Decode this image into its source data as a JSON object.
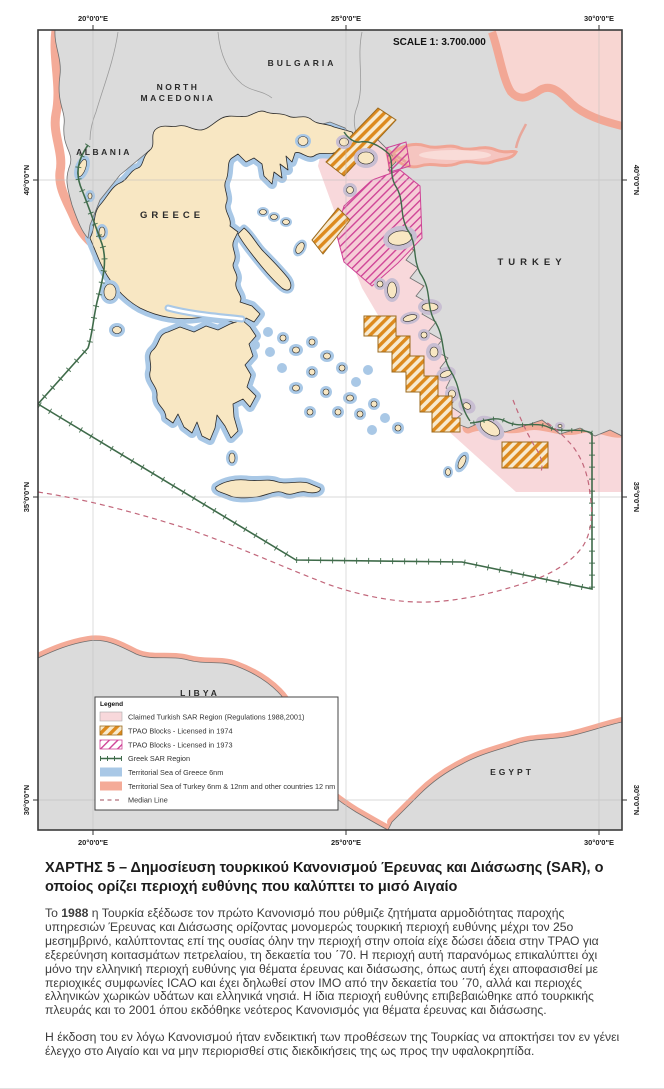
{
  "map": {
    "scale_label": "SCALE 1: 3.700.000",
    "countries": {
      "north_macedonia_line1": "NORTH",
      "north_macedonia_line2": "MACEDONIA",
      "bulgaria": "BULGARIA",
      "albania": "ALBANIA",
      "greece": "GREECE",
      "turkey": "TURKEY",
      "libya": "LIBYA",
      "egypt": "EGYPT"
    },
    "graticule": {
      "lon": [
        "20°0'0\"E",
        "25°0'0\"E",
        "30°0'0\"E"
      ],
      "lat": [
        "40°0'0\"N",
        "35°0'0\"N",
        "30°0'0\"N"
      ]
    }
  },
  "legend": {
    "title": "Legend",
    "items": [
      {
        "label": "Claimed Turkish SAR Region (Regulations 1988,2001)",
        "swatch": "pink-fill"
      },
      {
        "label": "TPAO Blocks - Licensed in 1974",
        "swatch": "orange-hatch"
      },
      {
        "label": "TPAO Blocks - Licensed in 1973",
        "swatch": "magenta-hatch"
      },
      {
        "label": "Greek SAR Region",
        "swatch": "green-tick-line"
      },
      {
        "label": "Territorial Sea of Greece 6nm",
        "swatch": "blue-fill"
      },
      {
        "label": "Territorial Sea of Turkey 6nm & 12nm and other countries 12 nm",
        "swatch": "salmon-fill"
      },
      {
        "label": "Median Line",
        "swatch": "dashed-line"
      }
    ]
  },
  "caption": {
    "title": "ΧΑΡΤΗΣ 5 – Δημοσίευση τουρκικού Κανονισμού Έρευνας και Διάσωσης (SAR), ο οποίος ορίζει περιοχή ευθύνης που καλύπτει το μισό Αιγαίο",
    "p1_pre": "Το ",
    "p1_bold": "1988",
    "p1_rest": " η Τουρκία εξέδωσε τον πρώτο Κανονισμό που ρύθμιζε ζητήματα αρμοδιότητας παροχής υπηρεσιών Έρευνας και Διάσωσης ορίζοντας μονομερώς τουρκική περιοχή ευθύνης μέχρι τον 25ο μεσημβρινό, καλύπτοντας επί της ουσίας όλην την περιοχή στην οποία είχε δώσει άδεια στην ΤΡΑΟ για εξερεύνηση κοιτασμάτων πετρελαίου, τη δεκαετία του ΄70. Η περιοχή αυτή παρανόμως επικαλύπτει όχι μόνο την ελληνική περιοχή ευθύνης για θέματα έρευνας και διάσωσης, όπως αυτή έχει αποφασισθεί με περιοχικές συμφωνίες ICAO και έχει δηλωθεί στον ΙΜΟ από την δεκαετία του ΄70, αλλά και περιοχές ελληνικών χωρικών υδάτων και ελληνικά νησιά. Η ίδια περιοχή ευθύνης επιβεβαιώθηκε από τουρκικής πλευράς και το 2001 όπου εκδόθηκε νεότερος Κανονισμός για θέματα έρευνας και διάσωσης.",
    "p2": "Η έκδοση του εν λόγω Κανονισμού ήταν ενδεικτική των προθέσεων της Τουρκίας να αποκτήσει τον εν γένει έλεγχο στο Αιγαίο και να μην περιορισθεί στις διεκδικήσεις της ως προς την υφαλοκρηπίδα."
  },
  "colors": {
    "sar_pink": "#f8d8db",
    "territorial_greece_blue": "#a9c8e6",
    "territorial_turkey_salmon": "#f4ab98",
    "tpao_1974_orange": "#dd8a1e",
    "tpao_1973_magenta": "#cf4396",
    "greek_sar_green": "#3f6b4a",
    "median_line_red": "#c2677b",
    "land_gray": "#dbdbdb",
    "greece_cream": "#f8e7c3",
    "overlap_lavender": "#c8bed2"
  }
}
